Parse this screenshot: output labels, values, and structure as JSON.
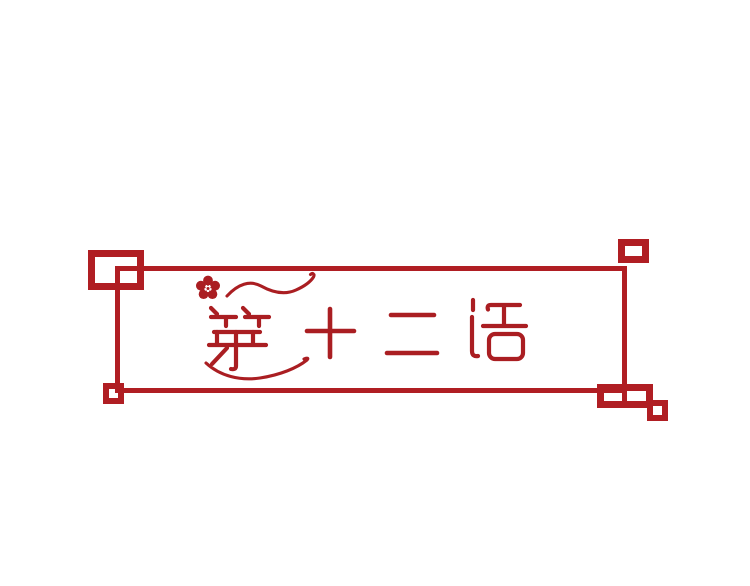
{
  "banner": {
    "title": "第十二话",
    "characters": [
      "第",
      "十",
      "二",
      "话"
    ],
    "decorations": [
      "plum-blossom-icon",
      "top-swirl-flourish",
      "bottom-swirl-flourish"
    ],
    "colors": {
      "frame": "#B01E23",
      "art": "#AA1E22"
    }
  }
}
